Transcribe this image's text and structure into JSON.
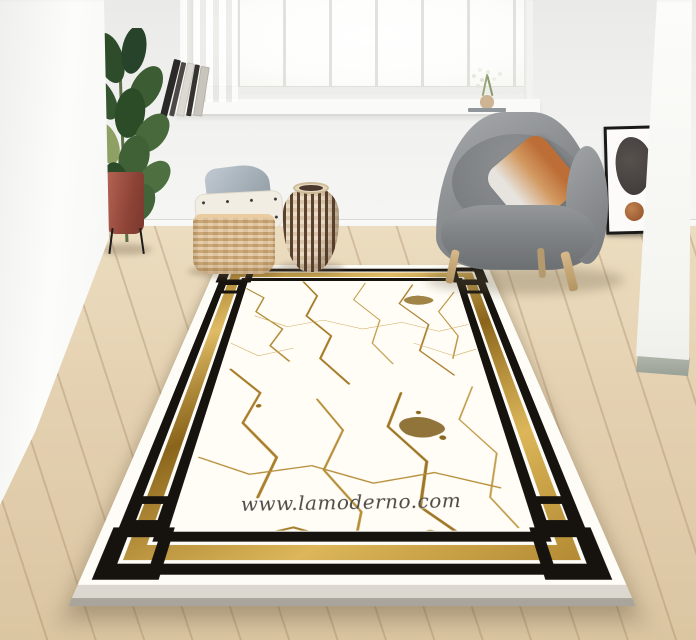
{
  "scene": {
    "type": "interior product photo of an area rug",
    "watermark": "www.lamoderno.com",
    "rug": {
      "field": "white marble with gold veining",
      "border": "double black bands with gold strip and greek-key corner knots"
    },
    "objects": [
      "rubber-plant-in-red-pot",
      "leaning-book-stack",
      "window-with-sheer-curtain",
      "flower-sprig-on-sill",
      "woven-square-basket",
      "gray-pillow",
      "white-speckled-pillow",
      "zigzag-wicker-vase",
      "gray-barrel-armchair",
      "ombre-orange-pillow",
      "leaning-framed-abstract-art",
      "oak-plank-floor"
    ],
    "palette": {
      "wall": "#f2f2f0",
      "floor": "#e2cfae",
      "rug_white": "#fdfcf7",
      "rug_black": "#16120d",
      "rug_gold": "#b8923a",
      "chair_gray": "#84878a",
      "pillow_orange": "#c4773f",
      "pot_red": "#8e4437",
      "basket_tan": "#dcb988",
      "art_blob": "#4a4442",
      "art_dot": "#a8653a"
    }
  }
}
